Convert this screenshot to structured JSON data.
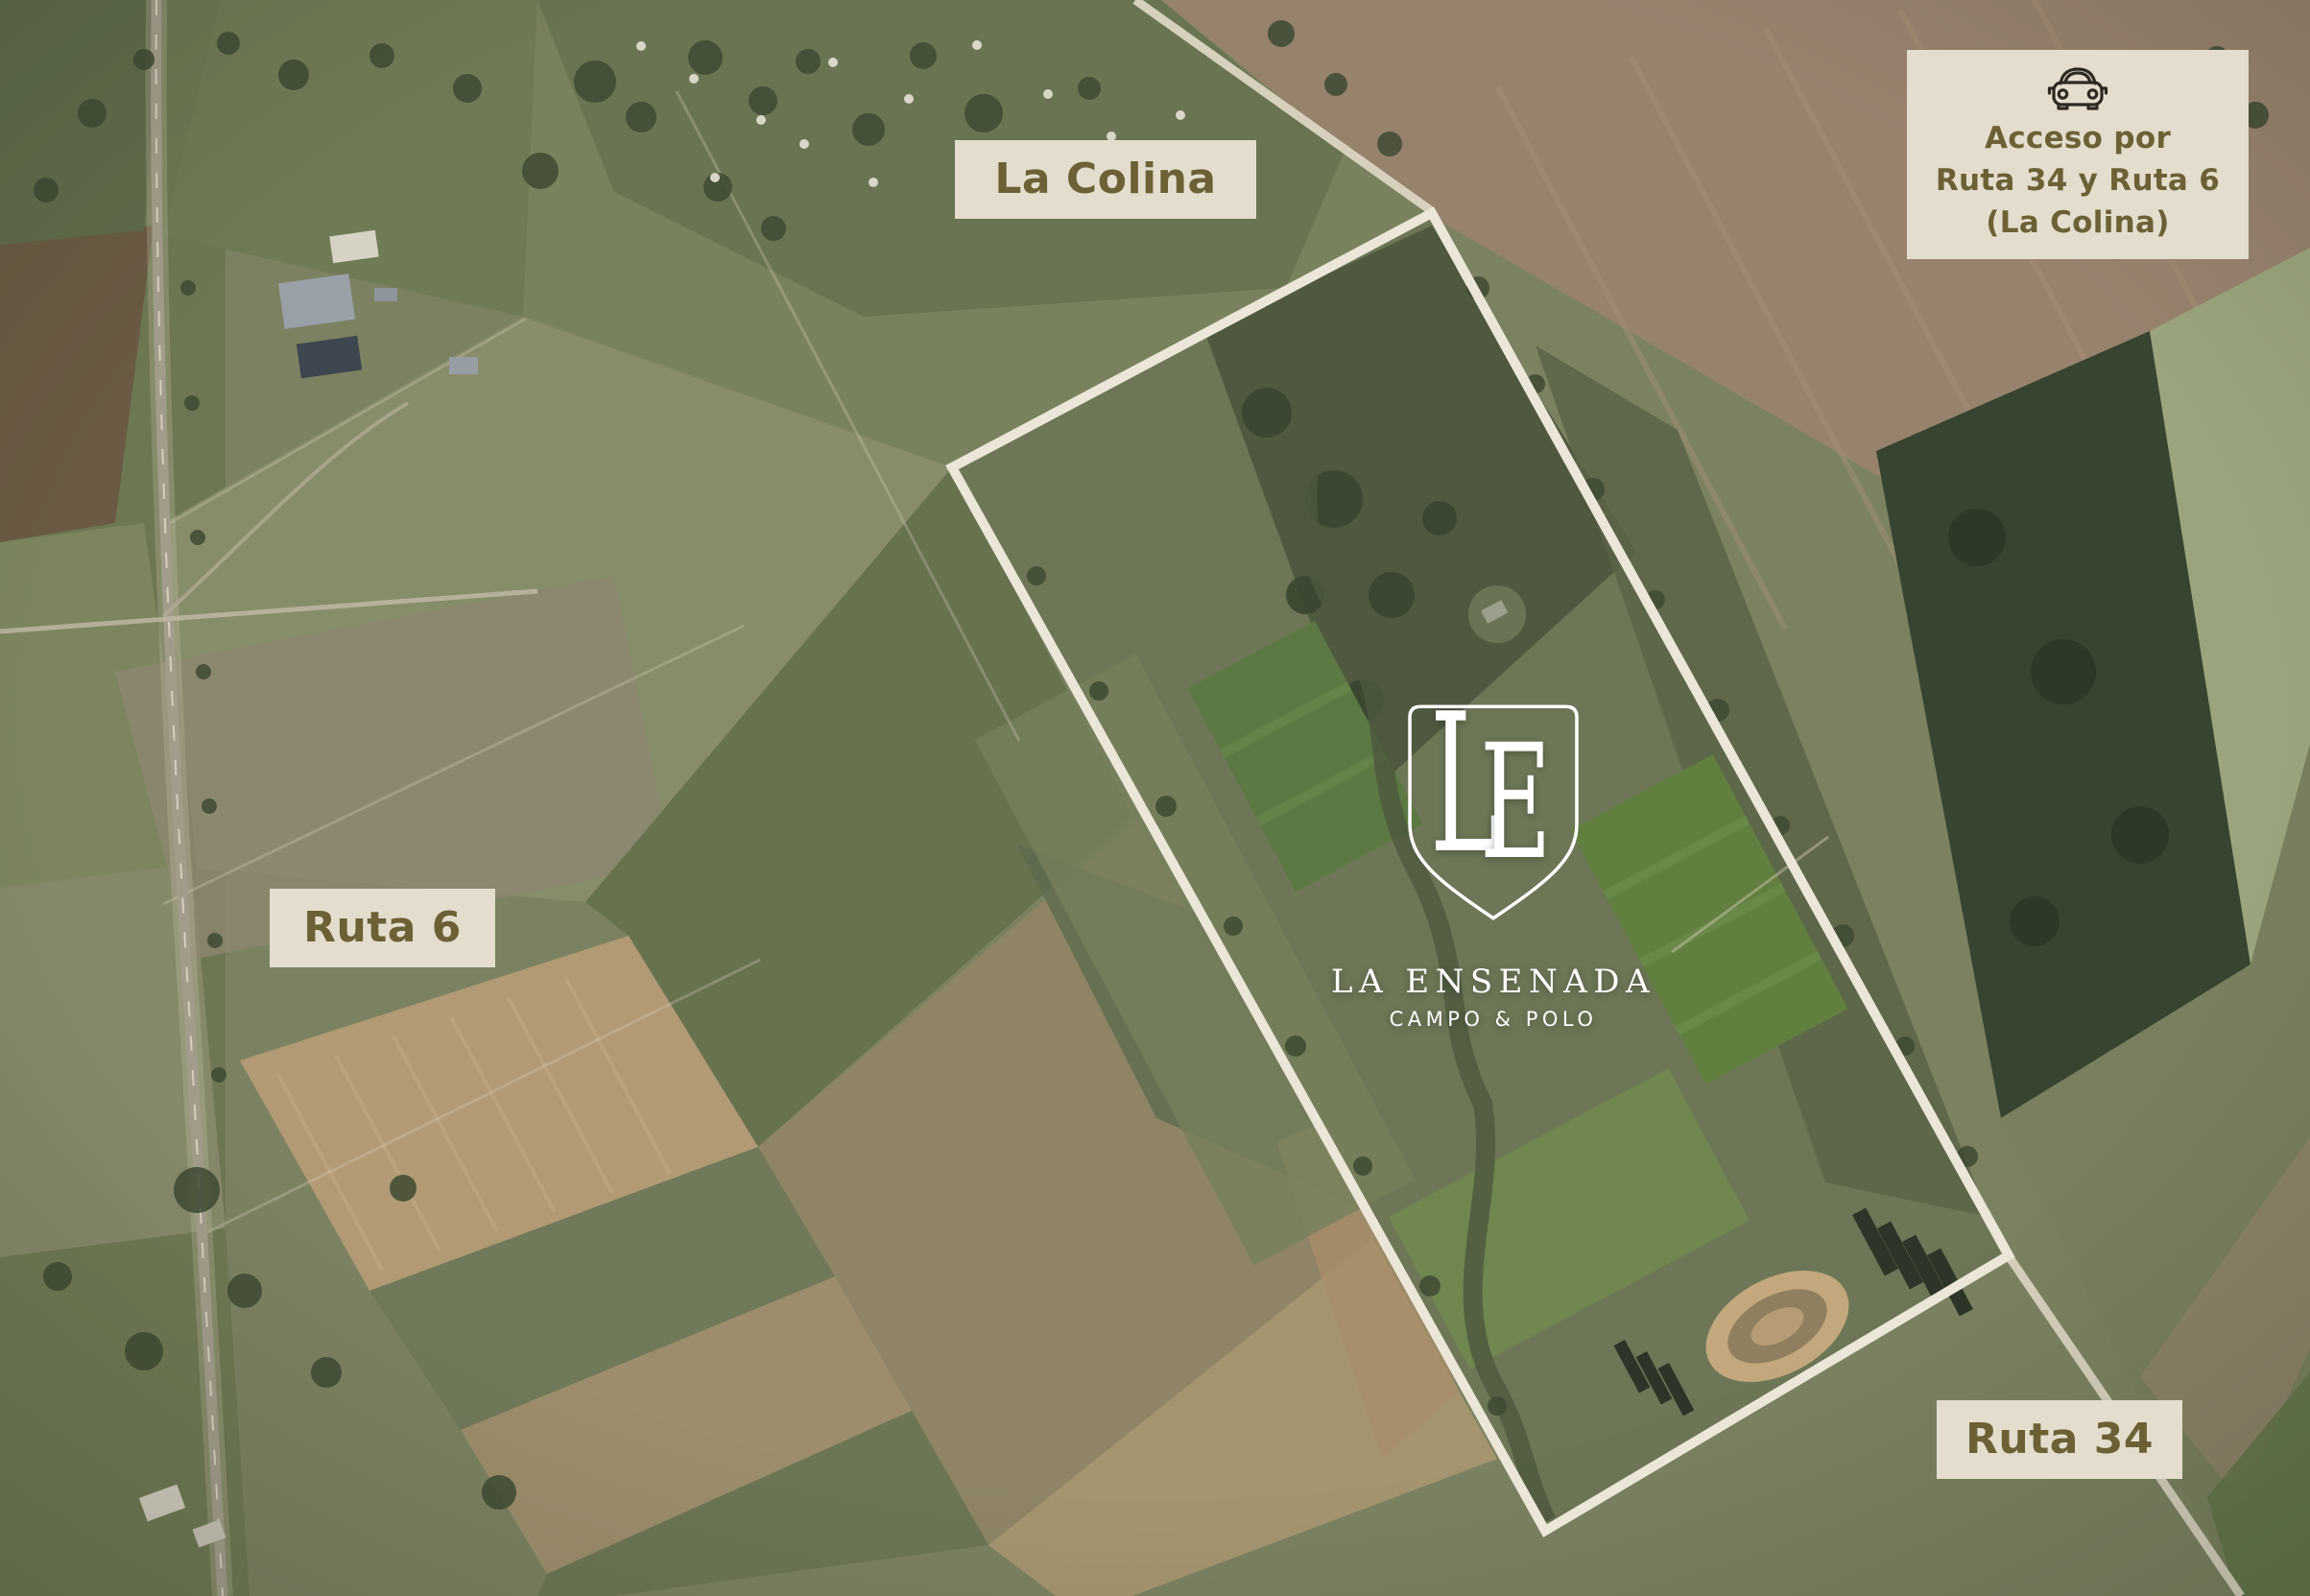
{
  "map": {
    "region_labels": {
      "la_colina": "La Colina",
      "ruta_6": "Ruta 6",
      "ruta_34": "Ruta 34"
    },
    "access_note": {
      "icon": "car-icon",
      "line1": "Acceso por",
      "line2": "Ruta 34 y Ruta 6",
      "line3": "(La Colina)"
    },
    "property_logo": {
      "monogram_l": "L",
      "monogram_e": "E",
      "name": "LA ENSENADA",
      "tagline": "CAMPO & POLO"
    },
    "colors": {
      "label_background": "#e4ddce",
      "label_text": "#6b6135",
      "boundary_outline": "#ece6d8",
      "logo_text": "#ffffff"
    }
  }
}
